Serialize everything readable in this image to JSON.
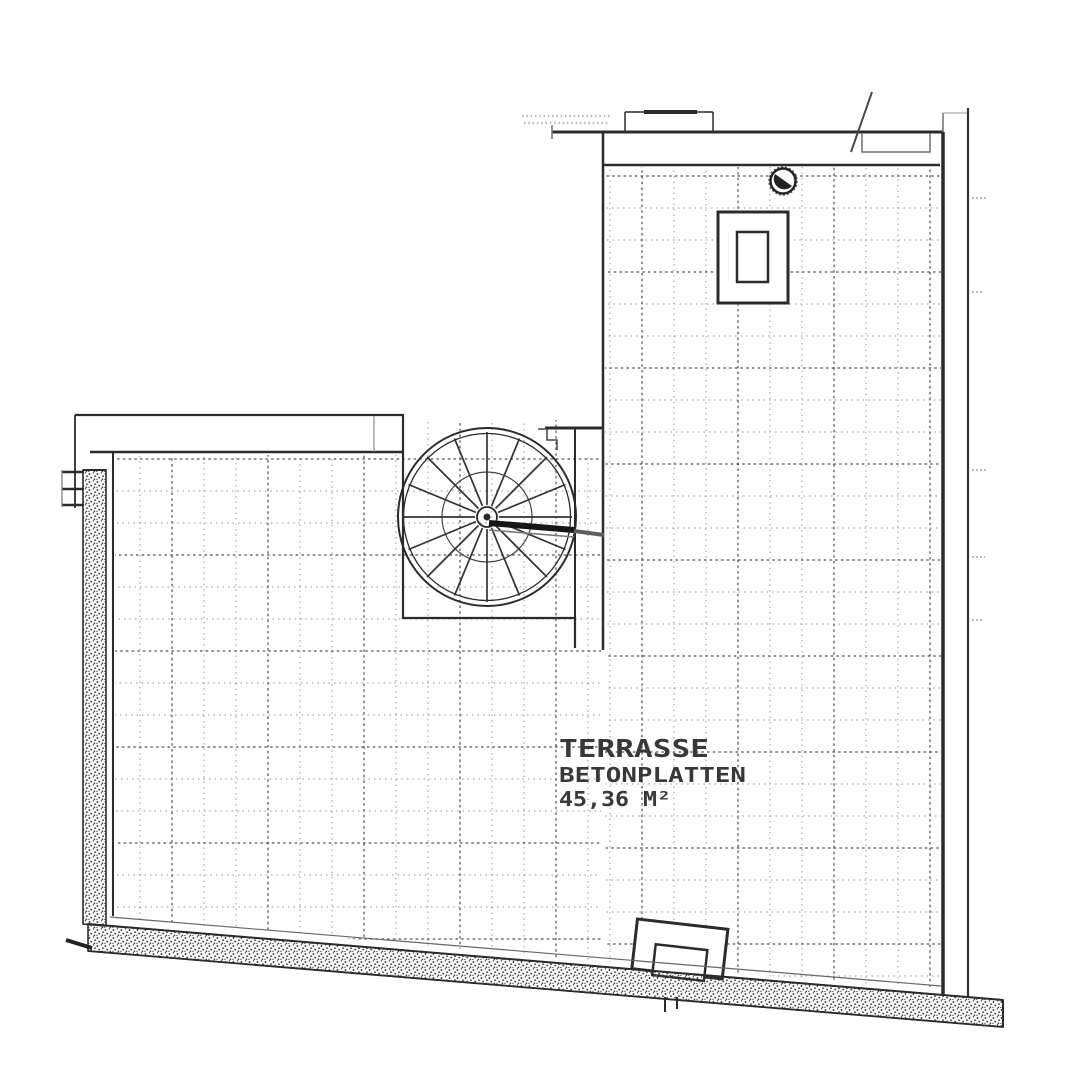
{
  "labels": {
    "room": "TERRASSE",
    "material": "BETONPLATTEN",
    "area": "45,36 M²"
  },
  "colors": {
    "paper": "#ffffff",
    "ink": "#2b2b2b",
    "ink_soft": "#6f6f6f",
    "grid_dash": "#4f4f4f",
    "stipple": "#3c3c3c"
  },
  "symbols": {
    "staircase": "spiral-staircase",
    "drain": "floor-drain",
    "hatch_upper": "roof-hatch",
    "hatch_lower": "roof-hatch",
    "wall_texture": "stippled-wall-hatch"
  }
}
